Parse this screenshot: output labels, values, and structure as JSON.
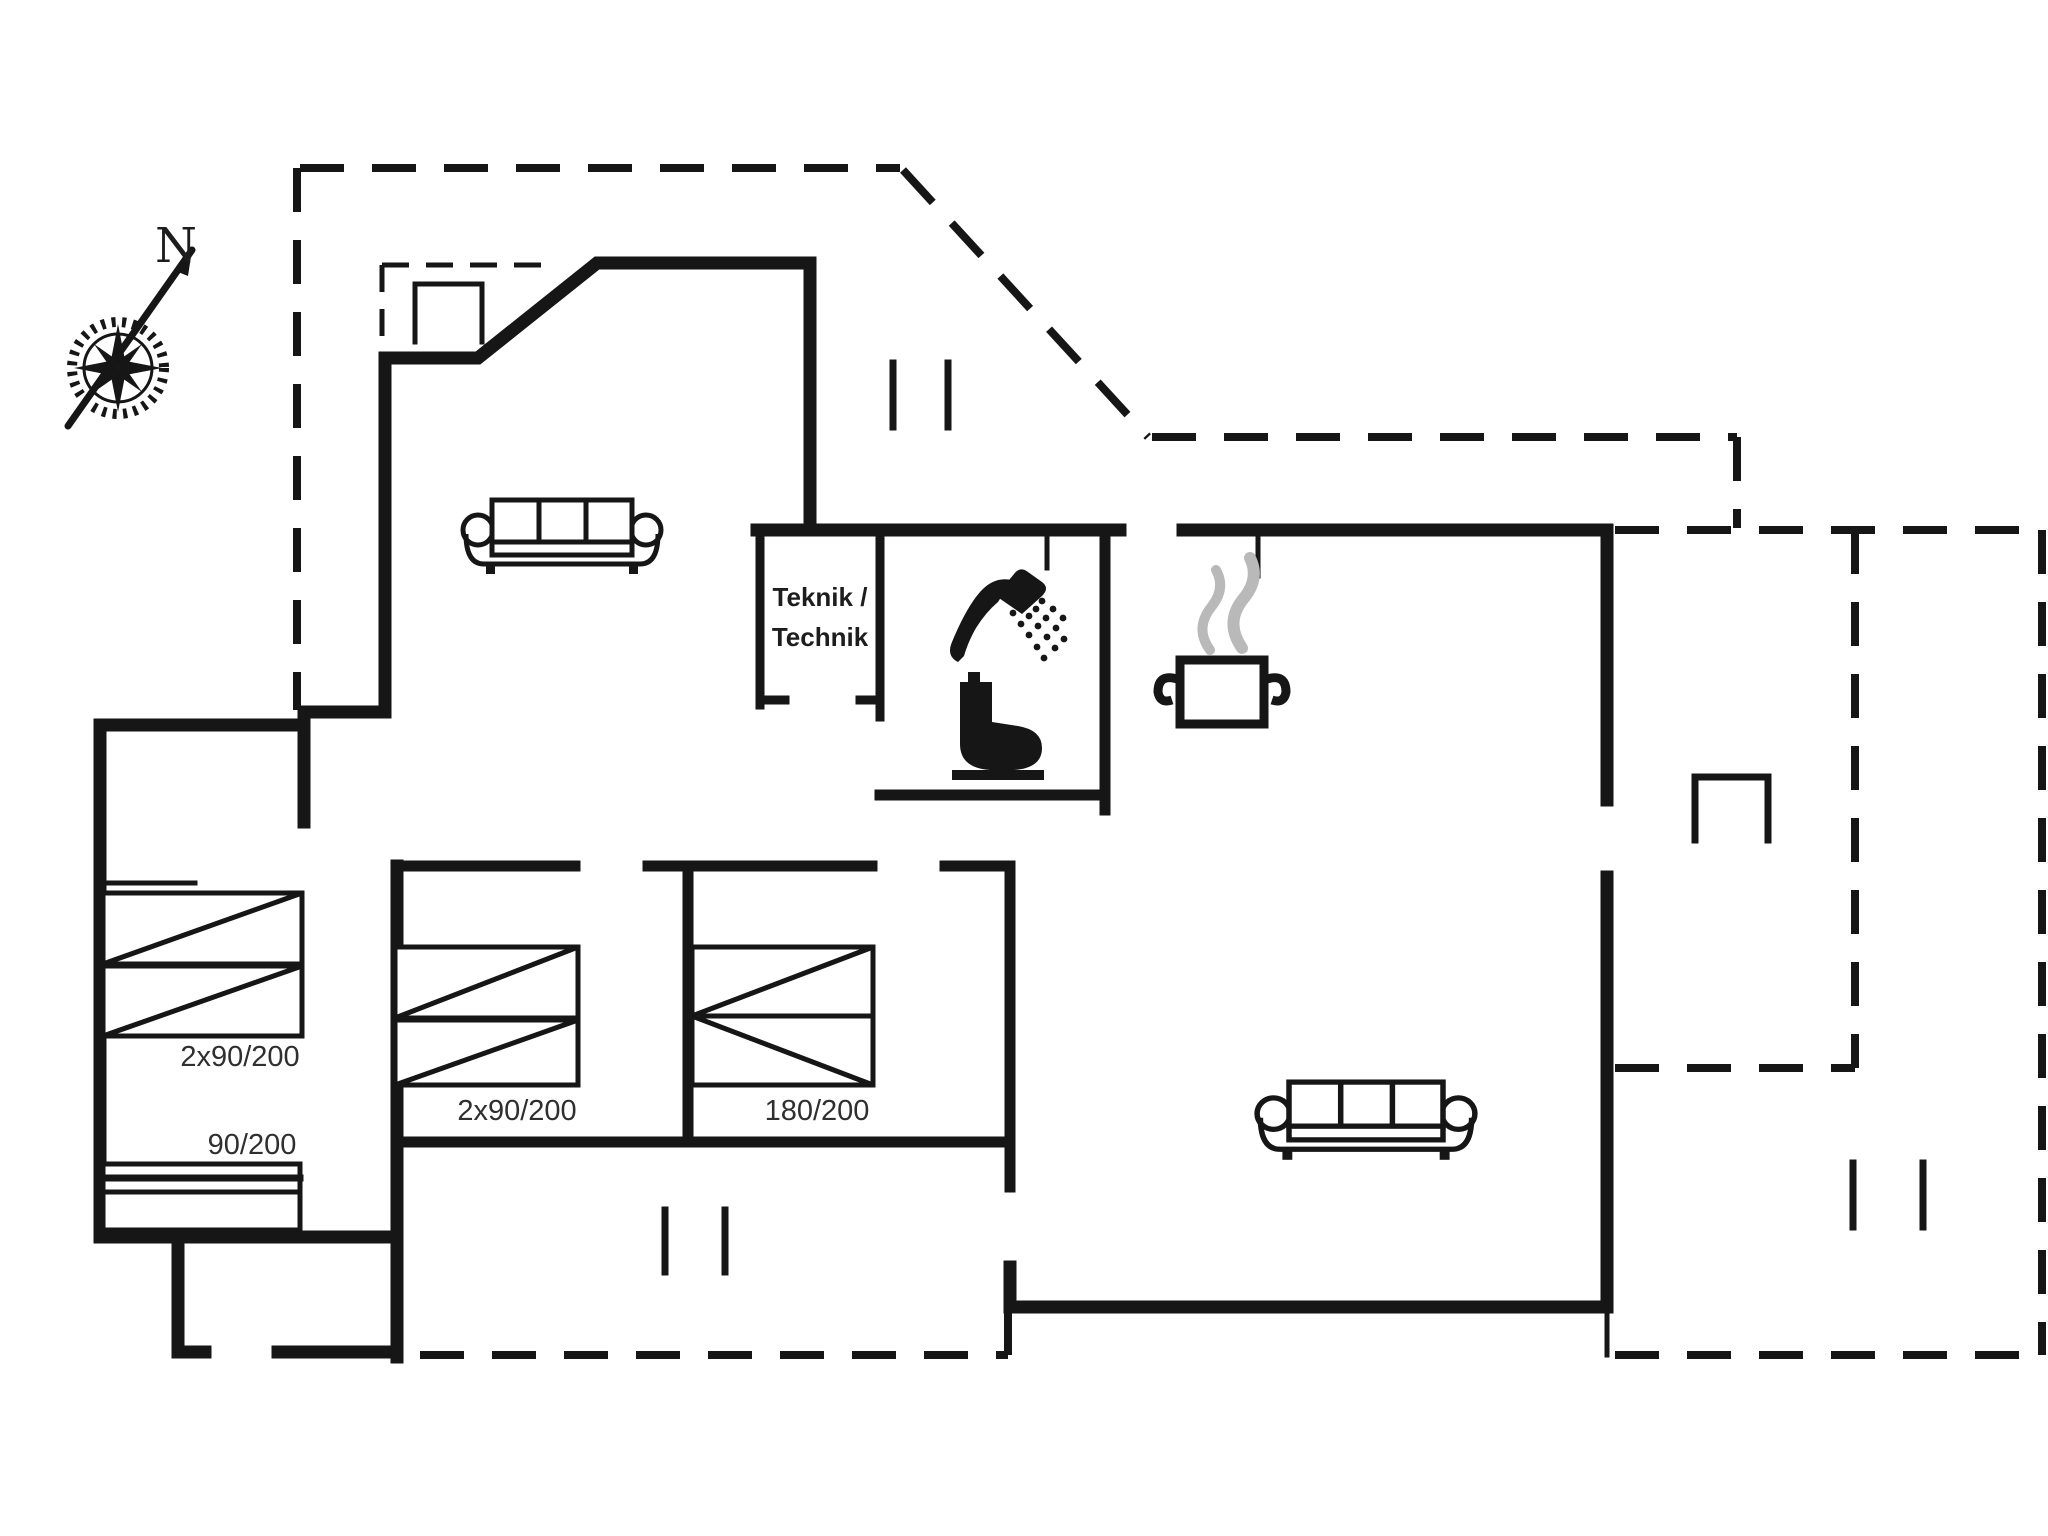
{
  "palette": {
    "background": "#ffffff",
    "line": "#161616",
    "label_text": "#2f2f2f",
    "steam": "#b9b9b9"
  },
  "compass": {
    "north_label": "N"
  },
  "rooms": {
    "technical": {
      "line1": "Teknik /",
      "line2": "Technik"
    }
  },
  "bedrooms": {
    "left_double_label": "2x90/200",
    "left_single_label": "90/200",
    "middle_double_label": "2x90/200",
    "right_double_label": "180/200"
  },
  "icons": {
    "compass": "compass-rose-icon",
    "sofa": "sofa-icon",
    "shower": "shower-icon",
    "toilet": "toilet-icon",
    "pot": "cooking-pot-icon",
    "fireplace": "fireplace-icon",
    "grill": "grill-icon",
    "threshold": "threshold-marker"
  }
}
